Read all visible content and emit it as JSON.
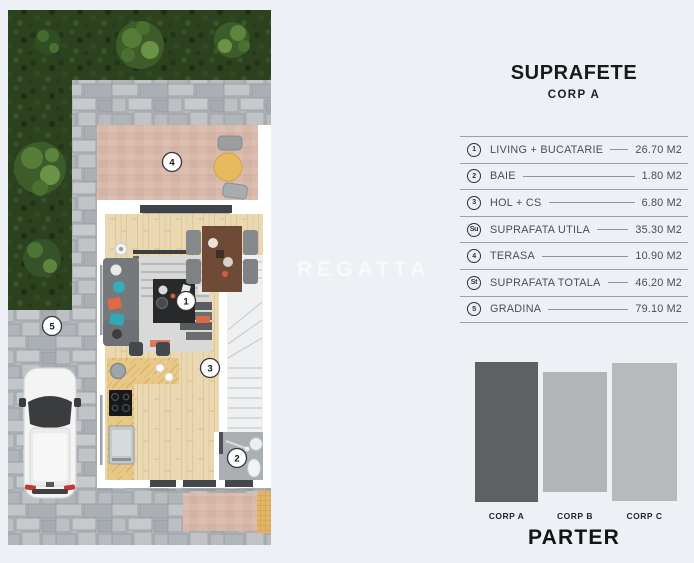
{
  "background_color": "#edf1f5",
  "watermark": "REGATTA",
  "plan": {
    "type": "floor-plan-top-view",
    "floor": "PARTER",
    "badges": [
      {
        "n": "1",
        "area": "living-bucatarie"
      },
      {
        "n": "2",
        "area": "baie"
      },
      {
        "n": "3",
        "area": "hol-cs"
      },
      {
        "n": "4",
        "area": "terasa"
      },
      {
        "n": "5",
        "area": "gradina"
      }
    ],
    "colors": {
      "hedge": "#2c421f",
      "pavers": "#b5b9bd",
      "terrace": "#d8b9aa",
      "wood_floor": "#ead8b1",
      "car_body": "#f4f4f4"
    }
  },
  "panel": {
    "title": "SUPRAFETE",
    "subtitle": "CORP A",
    "rows": [
      {
        "icon": "1",
        "label": "LIVING + BUCATARIE",
        "value": "26.70 M2"
      },
      {
        "icon": "2",
        "label": "BAIE",
        "value": "1.80 M2"
      },
      {
        "icon": "3",
        "label": "HOL + CS",
        "value": "6.80 M2"
      },
      {
        "icon": "Su",
        "label": "SUPRAFATA UTILA",
        "value": "35.30 M2"
      },
      {
        "icon": "4",
        "label": "TERASA",
        "value": "10.90 M2"
      },
      {
        "icon": "St",
        "label": "SUPRAFATA TOTALA",
        "value": "46.20 M2"
      },
      {
        "icon": "5",
        "label": "GRADINA",
        "value": "79.10 M2"
      }
    ],
    "legend": {
      "bars": [
        {
          "label": "CORP A",
          "color": "#5e6062",
          "height_px": 140,
          "highlighted": true
        },
        {
          "label": "CORP B",
          "color": "#b2b4b6",
          "height_px": 120,
          "highlighted": false
        },
        {
          "label": "CORP C",
          "color": "#b7b9bb",
          "height_px": 138,
          "highlighted": false
        }
      ],
      "floor_label": "PARTER"
    }
  }
}
